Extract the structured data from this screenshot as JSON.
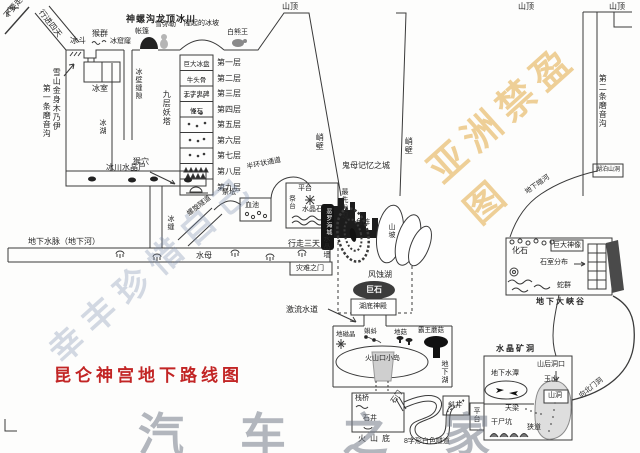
{
  "glacier": {
    "title": "神螺沟龙顶冰川",
    "no_go": "不要走",
    "march_four_days": "行进四天",
    "cirque": "冰斗",
    "monkeys": "猴群",
    "ice_hole": "冰窟窿",
    "tent": "帐篷",
    "snow_maitreya": "雪弥勒",
    "ice_bulge": "隆起的冰坡",
    "bear_king": "白熊王",
    "mummy": "雪山金身木乃伊",
    "ice_room": "冰室",
    "gully1": "第一条磨音沟",
    "ice_lake": "冰湖",
    "wall_crack": "冰壁缝隙",
    "monkey_cave": "猴穴"
  },
  "peaks": {
    "p1": "山顶",
    "p2": "山顶",
    "p3": "山顶"
  },
  "tower": {
    "name": "九层妖塔",
    "layers": [
      {
        "item": "巨大冰盘",
        "label": "第一层"
      },
      {
        "item": "牛头骨",
        "label": "第二层"
      },
      {
        "item": "无字鬼碑",
        "label": "第三层"
      },
      {
        "item": "怪石",
        "label": "第四层"
      },
      {
        "item": "",
        "label": "第五层"
      },
      {
        "item": "",
        "label": "第六层"
      },
      {
        "item": "",
        "label": "第七层"
      },
      {
        "item": "",
        "label": "第八层"
      },
      {
        "item": "",
        "label": "第九层"
      }
    ],
    "crystal_corpse": "冰川水晶尸",
    "ice_crack": "冰缝",
    "spiral_tunnel": "螺旋隧道"
  },
  "altar": {
    "small_altar": "祭坛",
    "blood_pool": "血池",
    "arc_passage": "半环状通道",
    "platform": "平台",
    "altar_stand": "祭台",
    "crystal_stone": "水晶石",
    "first_found": "最先发现"
  },
  "river": {
    "water_vein": "地下水脉（地下河）",
    "jellyfish": "水母",
    "walk_three_days": "行走三天",
    "crystal_wall": "水晶墙",
    "disaster_gate": "灾难之门"
  },
  "city": {
    "cliff_left": "峭壁",
    "cliff_right": "峭壁",
    "name": "鬼母记忆之城",
    "dark_city": "恶罗海城",
    "fish_array": "鱼阵",
    "hillside": "山坡",
    "wind_lake": "风蚀湖",
    "boulder": "巨石",
    "lake_temple": "湖底神殿",
    "torrent": "激流水道"
  },
  "lake": {
    "geo_crystal": "地磁晶",
    "tadpoles": "蝌蚪",
    "ground_mushroom": "地菇",
    "king_mushroom": "霸王蘑菇",
    "crater_isle": "火山口小岛",
    "underground_lake": "地下湖"
  },
  "volcano": {
    "plank_bridge": "栈桥",
    "stone_gate": "石门",
    "stone_well": "石井",
    "volcano_bottom": "火山底",
    "s_tunnel": "8字形白色隧道",
    "incline_shaft": "斜井"
  },
  "mine": {
    "name": "水晶矿洞",
    "water_pool": "地下水潭",
    "rear_entrance": "山后洞口",
    "jade_mountain": "玉山",
    "cave": "山洞",
    "north_gate": "向北门洞",
    "sky_beam": "天梁",
    "platform": "平台",
    "corpse_pit": "干尸坑",
    "narrow_path": "狭道"
  },
  "canyon": {
    "fossil": "化石",
    "giant_statue": "巨大神像",
    "stone_rooms": "石室分布",
    "snakes": "蛇群",
    "name": "地下大峡谷",
    "gully2": "第二条磨音沟",
    "dark_river": "地下暗河",
    "lake_cave": "湖泊山洞"
  },
  "footer": {
    "map_title": "昆仑神宫地下路线图"
  },
  "watermarks": {
    "center": "幸丰珍惜自己",
    "top_right": "亚洲禁盈图",
    "bottom_right": "汽车之家"
  },
  "colors": {
    "ink": "#3a3a3a",
    "title_red": "#c22525"
  }
}
